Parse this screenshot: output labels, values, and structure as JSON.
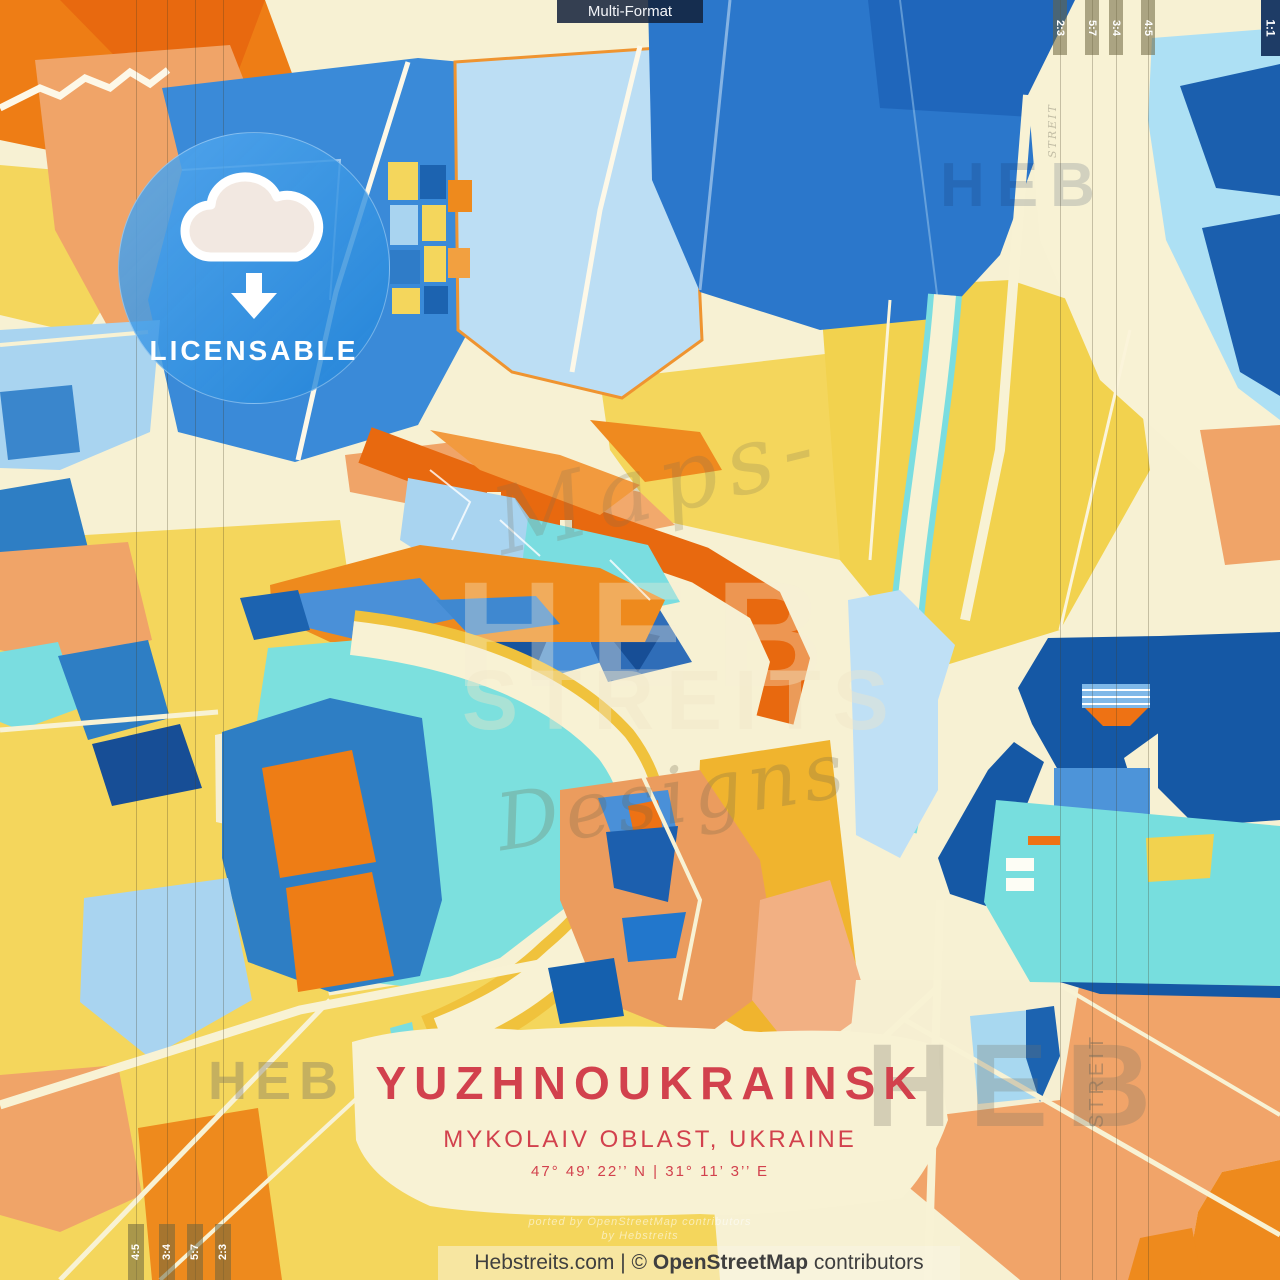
{
  "banner": {
    "label": "Multi-Format"
  },
  "format_tabs": {
    "top_right": [
      "2:3",
      "5:7",
      "3:4",
      "4:5"
    ],
    "square": "1:1",
    "bottom_left": [
      "4:5",
      "3:4",
      "5:7",
      "2:3"
    ]
  },
  "badge": {
    "label": "LICENSABLE",
    "icon": "cloud-download"
  },
  "title_block": {
    "title": "YUZHNOUKRAINSK",
    "subtitle": "MYKOLAIV OBLAST, UKRAINE",
    "coordinates": "47° 49’ 22’’ N | 31° 11’ 3’’ E"
  },
  "footer": {
    "site": "Hebstreits.com",
    "divider": "|",
    "copyright": "©",
    "osm": "OpenStreetMap",
    "contributors": "contributors"
  },
  "watermarks": {
    "heb_center": "HEB",
    "streits_center": "STREITS",
    "designs_script": "Designs",
    "maps_script": "Maps-",
    "heb_top_right": "HEB",
    "heb_bottom_left": "HEB",
    "heb_bottom_right": "HEB",
    "streit_vertical_right": "STREIT",
    "streit_vertical_top": "STREIT",
    "attribution_line1": "ported by OpenStreetMap contributors",
    "attribution_line2": "by Hebstreits"
  },
  "colors": {
    "accent_red": "#d2414d",
    "badge_blue": "#2f97e5",
    "cream": "#f7f1d3",
    "yellow": "#f4d65c",
    "amber": "#f0b42e",
    "orange": "#ee8a1d",
    "deep_orange": "#e8690f",
    "salmon": "#f0a468",
    "navy": "#1558a5",
    "blue": "#2f7cc8",
    "medium_blue": "#4e96d9",
    "light_blue": "#a9d4f0",
    "pale_blue": "#bcdef4",
    "turquoise": "#7adde0",
    "tab_olive": "#6c643e",
    "footer_text": "#3f3f3f"
  }
}
